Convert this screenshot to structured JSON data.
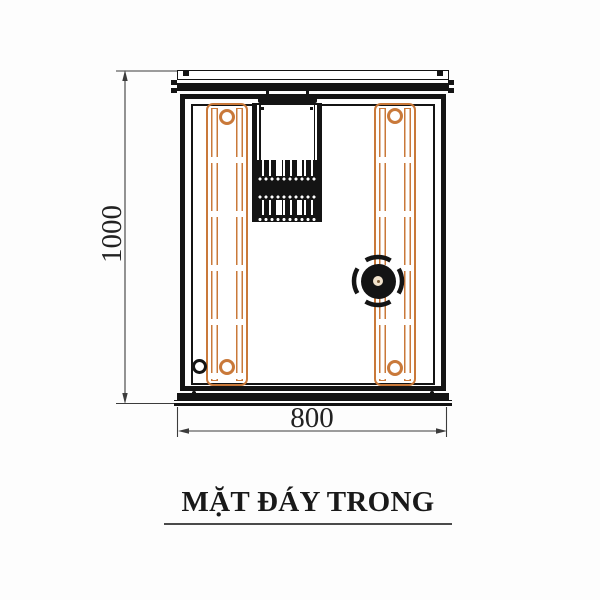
{
  "title": {
    "text": "MẶT ĐÁY TRONG"
  },
  "dimensions": {
    "height": "1000",
    "width": "800"
  },
  "colors": {
    "rail_orange": "#C9793A",
    "ink": "#141414",
    "dim_line": "#3C3C3C"
  },
  "parts": {
    "left_rail": "slide-rail",
    "right_rail": "slide-rail",
    "knob": "round-knob-fitting",
    "bracket": "slotted-vent-bracket",
    "small_hole": "round-hole"
  }
}
